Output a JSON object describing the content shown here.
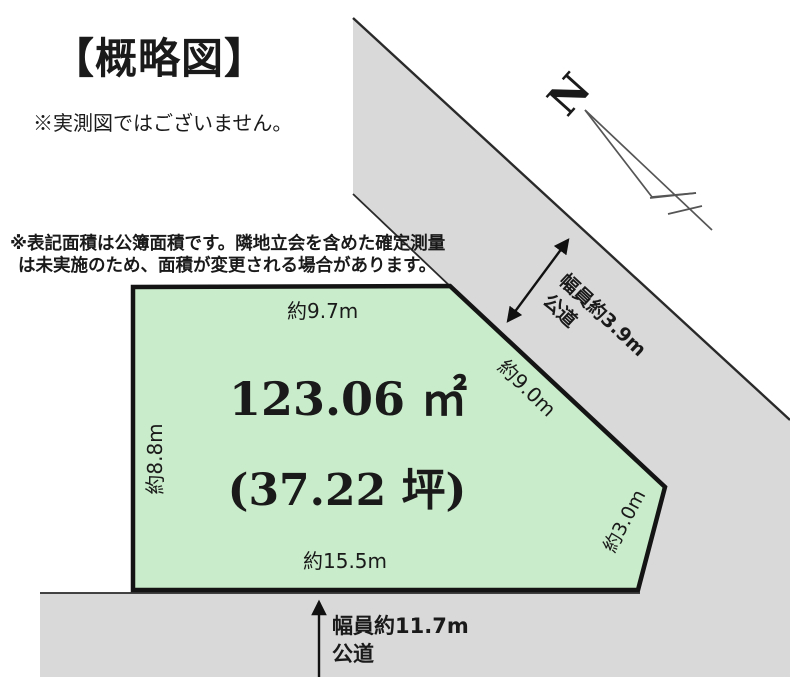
{
  "diagram": {
    "title": "【概略図】",
    "disclaimer": "※実測図ではございません。",
    "area_note_line1": "※表記面積は公簿面積です。隣地立会を含めた確定測量",
    "area_note_line2": "は未実施のため、面積が変更される場合があります。"
  },
  "plot": {
    "area_sqm": "123.06 ㎡",
    "area_tsubo": "(37.22 坪)",
    "edge_top": "約9.7m",
    "edge_left": "約8.8m",
    "edge_bottom": "約15.5m",
    "edge_diagonal": "約9.0m",
    "edge_right": "約3.0m",
    "fill_color": "#c9ecca",
    "border_color": "#141414"
  },
  "roads": {
    "fill_color": "#d9d9d9",
    "edge_line_color": "#2a2a2a",
    "northeast": {
      "width_label": "幅員約3.9m",
      "type_label": "公道"
    },
    "south": {
      "width_label": "幅員約11.7m",
      "type_label": "公道"
    }
  },
  "compass": {
    "north_label": "N"
  }
}
